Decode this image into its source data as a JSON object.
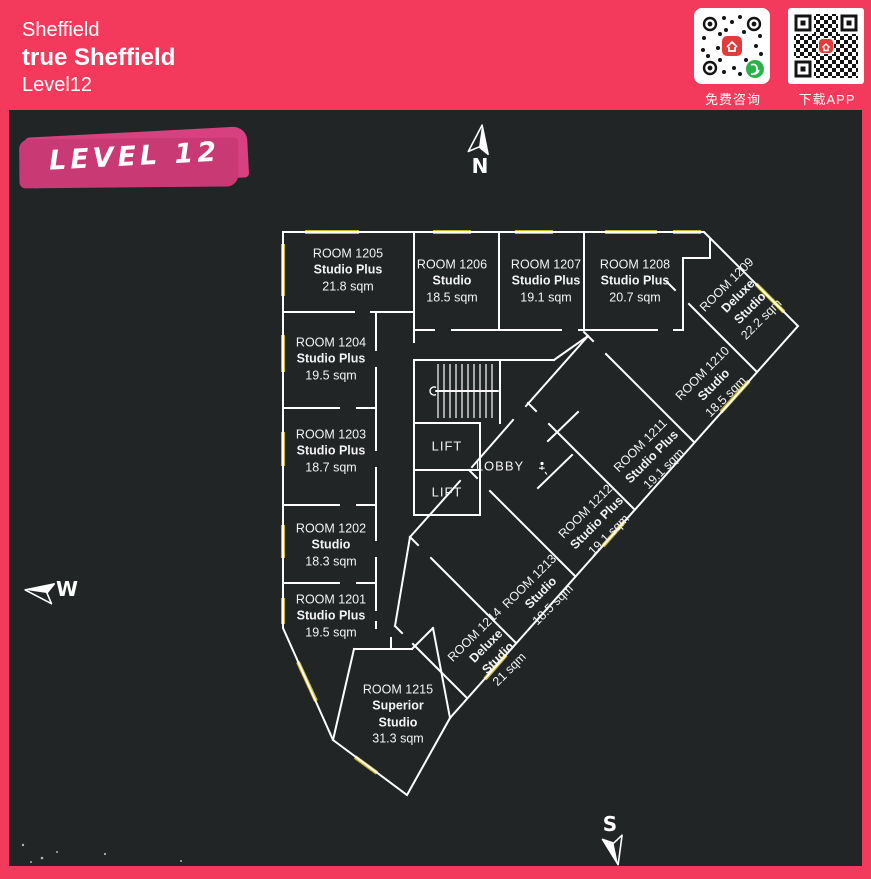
{
  "header": {
    "city": "Sheffield",
    "property": "true Sheffield",
    "level": "Level12",
    "qr_consult_label": "免费咨询",
    "qr_app_label": "下载APP"
  },
  "level_badge": "LEVEL 12",
  "compass": {
    "n": "N",
    "w": "W",
    "s": "S"
  },
  "core": {
    "lift1": "LIFT",
    "lift2": "LIFT",
    "lobby": "LOBBY"
  },
  "rooms": [
    {
      "id": "ROOM 1201",
      "type": "Studio Plus",
      "area": "19.5 sqm"
    },
    {
      "id": "ROOM 1202",
      "type": "Studio",
      "area": "18.3 sqm"
    },
    {
      "id": "ROOM 1203",
      "type": "Studio Plus",
      "area": "18.7 sqm"
    },
    {
      "id": "ROOM 1204",
      "type": "Studio Plus",
      "area": "19.5 sqm"
    },
    {
      "id": "ROOM 1205",
      "type": "Studio Plus",
      "area": "21.8 sqm"
    },
    {
      "id": "ROOM 1206",
      "type": "Studio",
      "area": "18.5 sqm"
    },
    {
      "id": "ROOM 1207",
      "type": "Studio Plus",
      "area": "19.1 sqm"
    },
    {
      "id": "ROOM 1208",
      "type": "Studio Plus",
      "area": "20.7 sqm"
    },
    {
      "id": "ROOM 1209",
      "type": "Deluxe Studio",
      "area": "22.2 sqm"
    },
    {
      "id": "ROOM 1210",
      "type": "Studio",
      "area": "18.5 sqm"
    },
    {
      "id": "ROOM 1211",
      "type": "Studio Plus",
      "area": "19.1 sqm"
    },
    {
      "id": "ROOM 1212",
      "type": "Studio Plus",
      "area": "19.1 sqm"
    },
    {
      "id": "ROOM 1213",
      "type": "Studio",
      "area": "18.5 sqm"
    },
    {
      "id": "ROOM 1214",
      "type": "Deluxe Studio",
      "area": "21 sqm"
    },
    {
      "id": "ROOM 1215",
      "type": "Superior Studio",
      "area": "31.3 sqm"
    }
  ],
  "colors": {
    "accent_pink": "#F43A5C",
    "brush_pink": "#D8417F",
    "panel_dark": "#212525",
    "wall_white": "#FFFFFF",
    "window_yellow": "#C9B42C"
  }
}
